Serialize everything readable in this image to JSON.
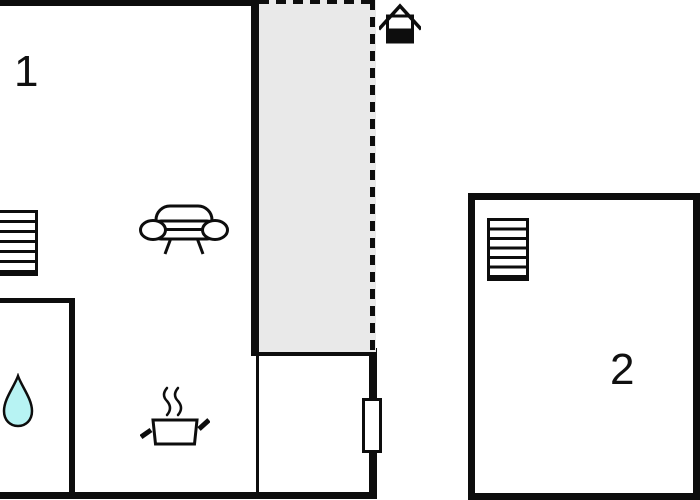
{
  "floorplan": {
    "rooms": [
      {
        "label": "1"
      },
      {
        "label": "2"
      }
    ],
    "colors": {
      "background": "#ffffff",
      "wall": "#0d0d0d",
      "terrace_fill": "#e9e9e9",
      "water_drop_fill": "#b7f3f3",
      "window_fill": "#ffffff"
    },
    "icons": [
      {
        "name": "house-entrance-icon"
      },
      {
        "name": "stairs-icon"
      },
      {
        "name": "sofa-icon"
      },
      {
        "name": "cooking-pot-icon"
      },
      {
        "name": "steam-icon"
      },
      {
        "name": "water-drop-icon"
      },
      {
        "name": "window-marker"
      }
    ],
    "terrace_outline_style": "dashed"
  }
}
